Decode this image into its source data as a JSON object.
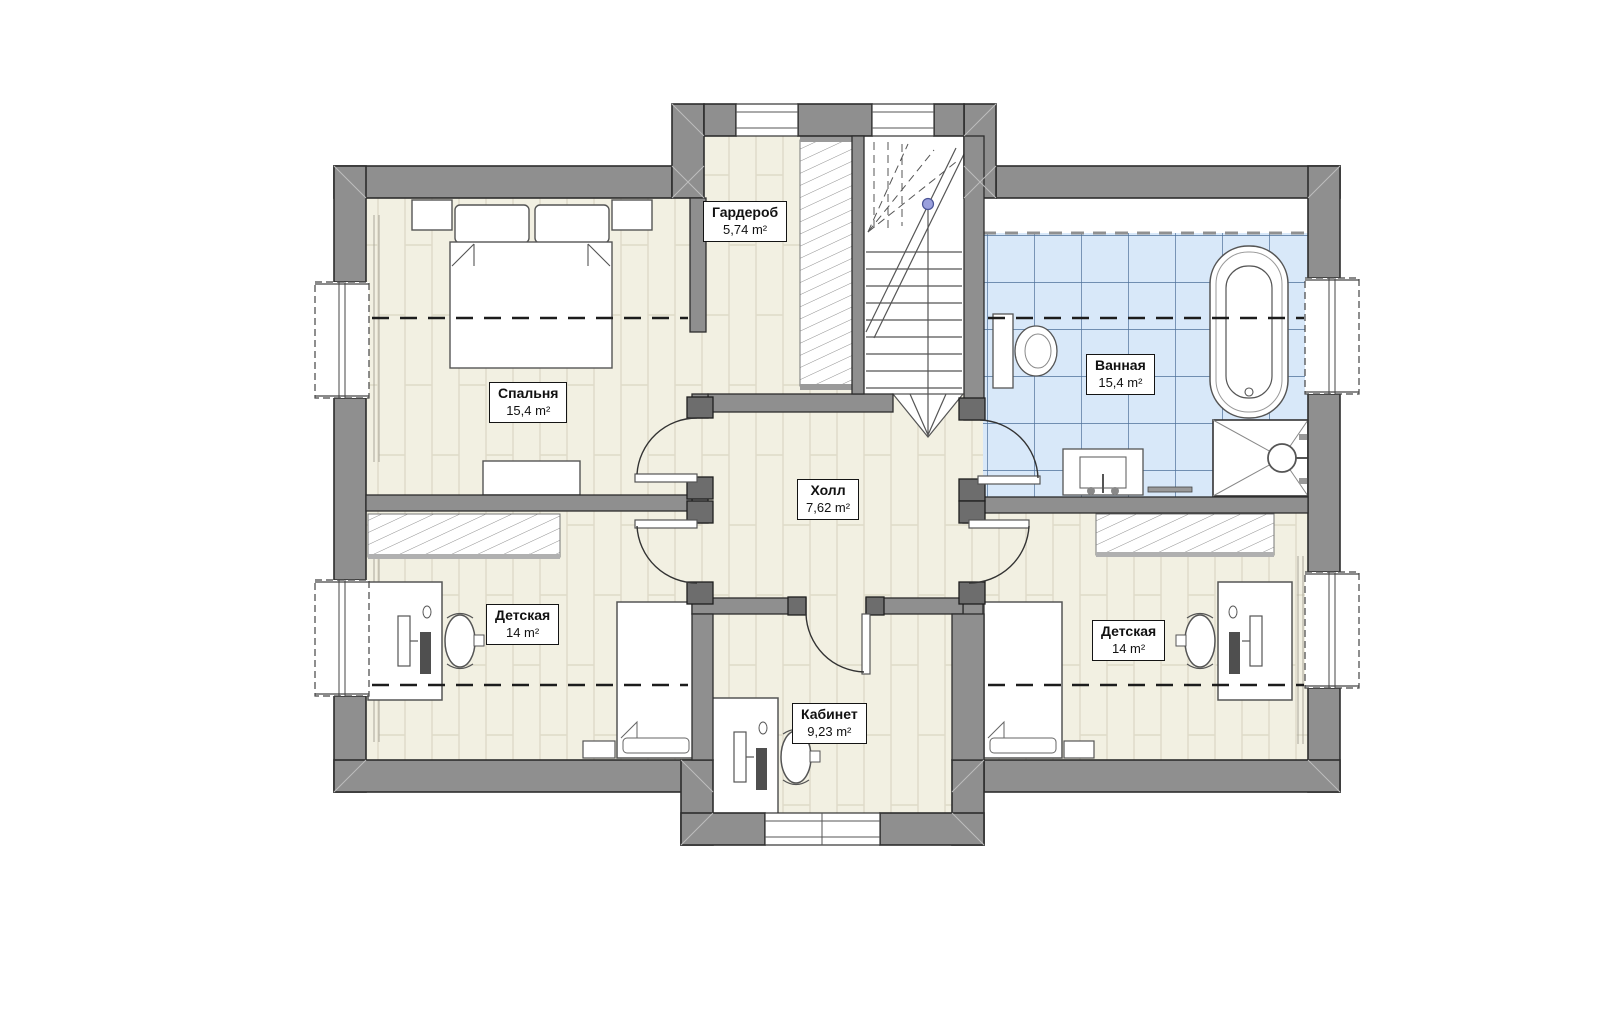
{
  "plan": {
    "rooms": [
      {
        "id": "wardrobe",
        "name": "Гардероб",
        "area": "5,74 m²"
      },
      {
        "id": "bedroom",
        "name": "Спальня",
        "area": "15,4 m²"
      },
      {
        "id": "bathroom",
        "name": "Ванная",
        "area": "15,4 m²"
      },
      {
        "id": "hall",
        "name": "Холл",
        "area": "7,62 m²"
      },
      {
        "id": "kids-left",
        "name": "Детская",
        "area": "14 m²"
      },
      {
        "id": "kids-right",
        "name": "Детская",
        "area": "14 m²"
      },
      {
        "id": "office",
        "name": "Кабинет",
        "area": "9,23 m²"
      }
    ],
    "colors": {
      "wall": "#8f8f8f",
      "wall_outline": "#2d2d2d",
      "floor": "#f2f0e2",
      "floor_line": "#dedac8",
      "bath_tile": "#d8e8f9",
      "bath_tile_line": "#4e7199",
      "fixture_line": "#555555",
      "stair_marker": "#9aa0dd"
    }
  }
}
